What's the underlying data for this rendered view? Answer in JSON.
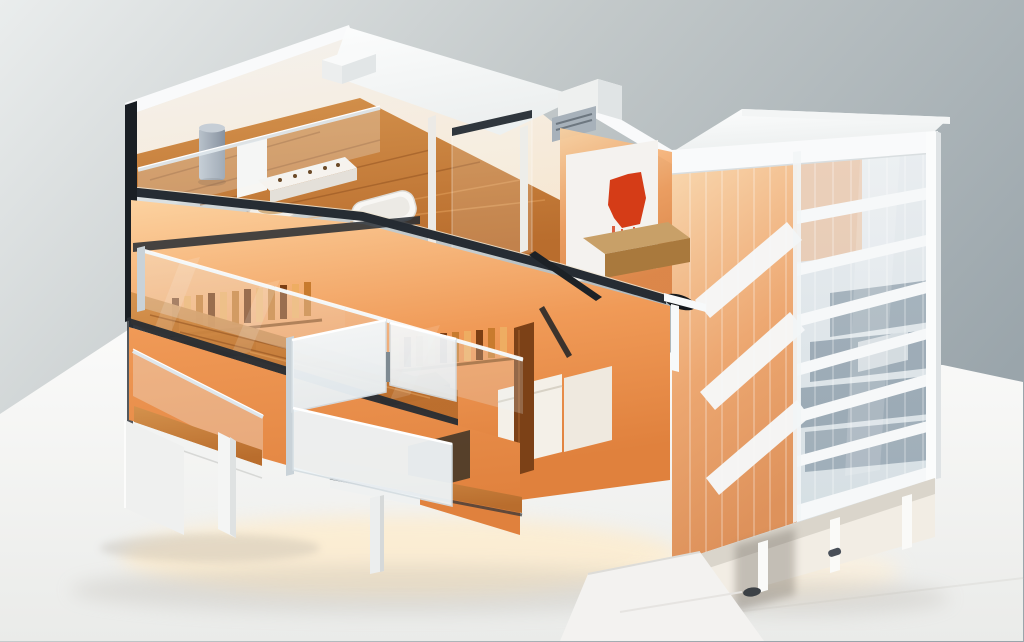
{
  "scene": {
    "type": "3d-isometric-cutaway-render",
    "subject": "multi-storey building dollhouse cross-section with amber-lit interiors",
    "left_wing_floors": [
      {
        "name": "top-floor"
      },
      {
        "name": "middle-floor"
      },
      {
        "name": "lower-floor"
      }
    ],
    "tower_spandrel_bands": 7,
    "floating_facade_panels": 3,
    "support_pillars": 3
  },
  "palette": {
    "bg_top": "#eaeded",
    "bg_mid": "#c3c9ca",
    "bg_deep": "#9aa5ab",
    "ground_top": "#fbfbfa",
    "ground_bottom": "#eaebe9",
    "roof_white": "#f9fafb",
    "band_white": "#f6f8f9",
    "wall_white": "#f4f2ef",
    "wall_warm": "#f7e7d1",
    "slab_dark": "#262c33",
    "glow_bright": "#fcd2a0",
    "glow_mid": "#f09a57",
    "glow_deep": "#e0813d",
    "wood_light": "#d4924d",
    "wood_mid": "#b96d2d",
    "wood_dark": "#8a4c1d",
    "glass_pale_top": "#e9edf0",
    "glass_pale_bottom": "#d3dde2",
    "glass_slate": "#5e7486",
    "panel_top": "#f6f9fb",
    "panel_bottom": "#e7eef2",
    "frame_silver": "#c9d2d8",
    "artwork_red": "#d53c17",
    "metal_light": "#b9c2cb",
    "metal_dark": "#8792a0",
    "bench_tan": "#c8a068",
    "bench_dark": "#a9793d",
    "trunk_brown": "#7c4117",
    "shadow_warm": "#ffeccb",
    "shadow_gray": "#b3aea6"
  }
}
